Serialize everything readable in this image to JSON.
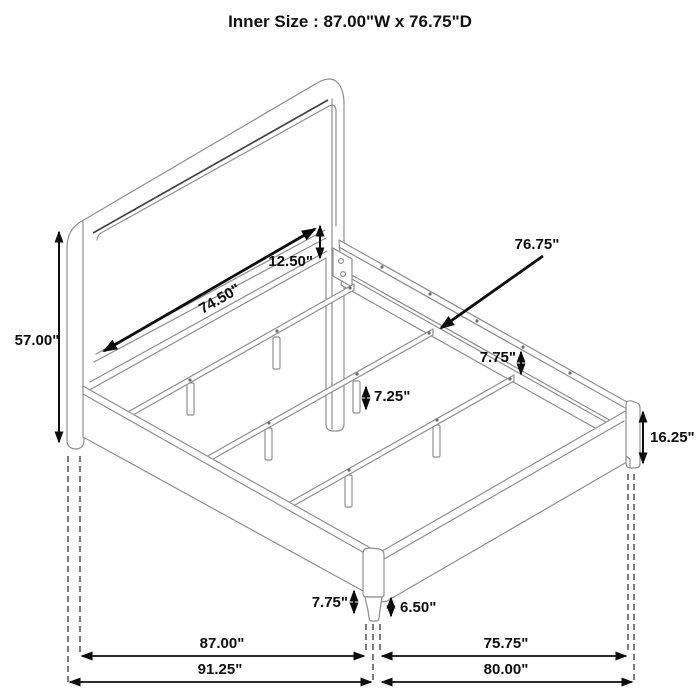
{
  "title": "Inner Size : 87.00\"W x 76.75\"D",
  "drawing": {
    "type": "furniture-dimension-diagram",
    "subject": "bed-frame-isometric-view"
  },
  "annotations": {
    "headboard_inner_width": "74.50\"",
    "panel_to_rail_gap": "12.50\"",
    "headboard_height": "57.00\"",
    "side_rail_inner_depth": "76.75\"",
    "side_rail_height": "7.75\"",
    "center_leg_height": "7.25\"",
    "footboard_height": "16.25\"",
    "rail_floor_clearance": "7.75\"",
    "footboard_floor_clearance": "6.50\"",
    "inner_width_bottom": "87.00\"",
    "inner_depth_bottom": "75.75\"",
    "overall_width_bottom": "91.25\"",
    "overall_depth_bottom": "80.00\""
  }
}
